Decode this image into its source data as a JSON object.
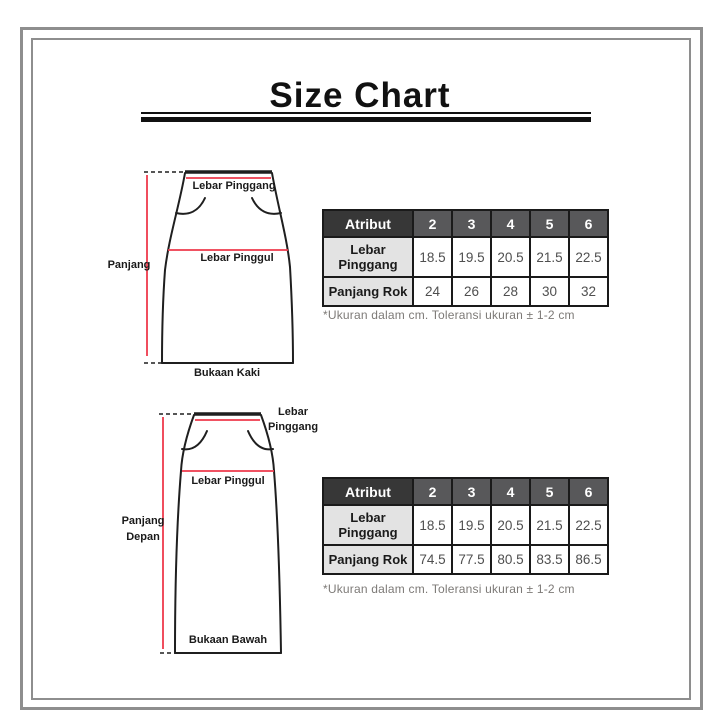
{
  "title": "Size Chart",
  "colors": {
    "accent_red": "#ee3a4c",
    "outline": "#1f1f1f",
    "frame_gray": "#8e8e8e",
    "header_dark": "#373737",
    "header_gray": "#58585a",
    "row_label_bg": "#e3e3e3",
    "value_text": "#4f4f4f",
    "footnote_text": "#7d7a77"
  },
  "diagram1": {
    "labels": {
      "waist": "Lebar Pinggang",
      "hip": "Lebar Pinggul",
      "length": "Panjang",
      "hem": "Bukaan Kaki"
    }
  },
  "diagram2": {
    "labels": {
      "waist_line1": "Lebar",
      "waist_line2": "Pinggang",
      "hip": "Lebar Pinggul",
      "length_line1": "Panjang",
      "length_line2": "Depan",
      "hem": "Bukaan Bawah"
    }
  },
  "table1": {
    "header": [
      "Atribut",
      "2",
      "3",
      "4",
      "5",
      "6"
    ],
    "rows": [
      {
        "label": "Lebar Pinggang",
        "values": [
          "18.5",
          "19.5",
          "20.5",
          "21.5",
          "22.5"
        ]
      },
      {
        "label": "Panjang Rok",
        "values": [
          "24",
          "26",
          "28",
          "30",
          "32"
        ]
      }
    ],
    "footnote": "*Ukuran dalam cm. Toleransi ukuran ± 1-2 cm"
  },
  "table2": {
    "header": [
      "Atribut",
      "2",
      "3",
      "4",
      "5",
      "6"
    ],
    "rows": [
      {
        "label": "Lebar Pinggang",
        "values": [
          "18.5",
          "19.5",
          "20.5",
          "21.5",
          "22.5"
        ]
      },
      {
        "label": "Panjang Rok",
        "values": [
          "74.5",
          "77.5",
          "80.5",
          "83.5",
          "86.5"
        ]
      }
    ],
    "footnote": "*Ukuran dalam cm. Toleransi ukuran ± 1-2 cm"
  }
}
